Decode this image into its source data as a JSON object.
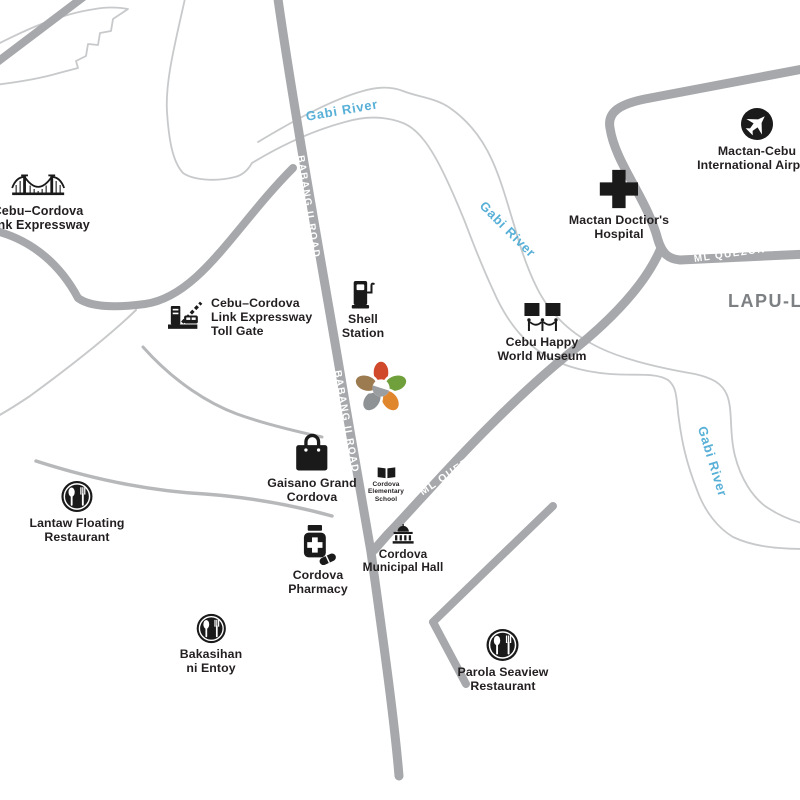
{
  "map": {
    "city_label": "LAPU-LAPU",
    "river_label": "Gabi River",
    "road_labels": {
      "babang": "BABANG II ROAD",
      "ml_quezon": "ML QUEZON NATIONAL HIGHWAY",
      "basak_marigondon": "BASAK MARIGONDON RD"
    },
    "landmarks": {
      "cclex": {
        "label": "Cebu–Cordova\nLink Expressway",
        "icon": "bridge"
      },
      "toll_gate": {
        "label": "Cebu–Cordova\nLink Expressway\nToll Gate",
        "icon": "toll-gate"
      },
      "shell": {
        "label": "Shell\nStation",
        "icon": "gas-pump"
      },
      "hospital": {
        "label": "Mactan Doctior's\nHospital",
        "icon": "medical-cross"
      },
      "airport": {
        "label": "Mactan-Cebu\nInternational Airport",
        "icon": "airplane"
      },
      "museum": {
        "label": "Cebu Happy\nWorld Museum",
        "icon": "museum-gallery"
      },
      "gaisano": {
        "label": "Gaisano Grand\nCordova",
        "icon": "shopping-bag"
      },
      "school": {
        "label": "Cordova\nElementary\nSchool",
        "icon": "open-book"
      },
      "municipal_hall": {
        "label": "Cordova\nMunicipal Hall",
        "icon": "government-building"
      },
      "pharmacy": {
        "label": "Cordova\nPharmacy",
        "icon": "medicine-bottle"
      },
      "lantaw": {
        "label": "Lantaw Floating\nRestaurant",
        "icon": "restaurant"
      },
      "bakasihan": {
        "label": "Bakasihan\nni Entoy",
        "icon": "restaurant"
      },
      "parola": {
        "label": "Parola Seaview\nRestaurant",
        "icon": "restaurant"
      }
    },
    "colors": {
      "road": "#a6a8ab",
      "road_thin": "#b6b8ba",
      "outline": "#c7c9cb",
      "river_text": "#58b0d7",
      "label_text": "#231f20",
      "city_text": "#7d8083",
      "road_text": "#ffffff",
      "logo_petals": [
        "#d0492b",
        "#6fa03c",
        "#e0862c",
        "#8f9295",
        "#9c7b50"
      ]
    }
  }
}
